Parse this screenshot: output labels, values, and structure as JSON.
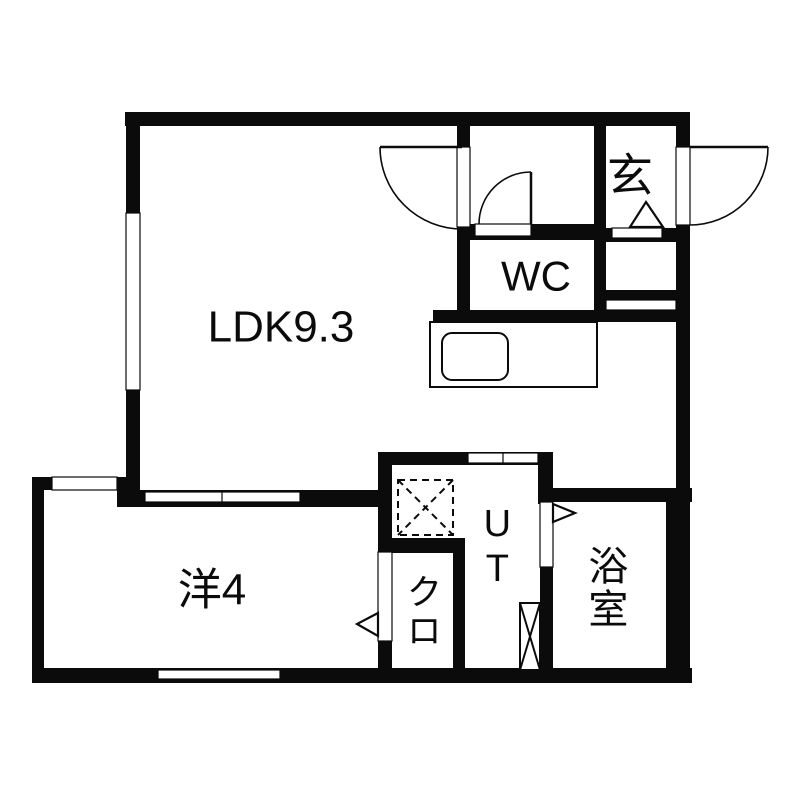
{
  "floorplan": {
    "canvas": {
      "width": 800,
      "height": 800,
      "bg": "#ffffff"
    },
    "colors": {
      "wall": "#0b0b0b",
      "line": "#0b0b0b",
      "floor": "#ffffff"
    },
    "rooms": [
      {
        "id": "ldk",
        "label": "LDK9.3",
        "x": 281,
        "y": 328,
        "font": 44,
        "orientation": "horizontal"
      },
      {
        "id": "genkan",
        "label": "玄",
        "x": 630,
        "y": 176,
        "font": 46,
        "orientation": "horizontal"
      },
      {
        "id": "wc",
        "label": "WC",
        "x": 536,
        "y": 277,
        "font": 42,
        "orientation": "horizontal"
      },
      {
        "id": "utility",
        "label": "UT",
        "x": 497,
        "y": 548,
        "font": 38,
        "orientation": "vertical"
      },
      {
        "id": "bathroom",
        "label": "浴室",
        "x": 604,
        "y": 588,
        "font": 40,
        "orientation": "vertical"
      },
      {
        "id": "closet",
        "label": "クロ",
        "x": 421,
        "y": 612,
        "font": 36,
        "orientation": "vertical"
      },
      {
        "id": "western-room",
        "label": "洋4",
        "x": 212,
        "y": 591,
        "font": 44,
        "orientation": "horizontal"
      }
    ],
    "walls": [
      {
        "name": "top-exterior",
        "x": 125,
        "y": 112,
        "w": 565,
        "h": 14
      },
      {
        "name": "left-exterior-upper",
        "x": 126,
        "y": 112,
        "w": 14,
        "h": 378
      },
      {
        "name": "left-jog",
        "x": 32,
        "y": 477,
        "w": 108,
        "h": 13
      },
      {
        "name": "left-exterior-lower",
        "x": 32,
        "y": 477,
        "w": 12,
        "h": 206
      },
      {
        "name": "bottom-exterior",
        "x": 32,
        "y": 668,
        "w": 660,
        "h": 15
      },
      {
        "name": "right-exterior",
        "x": 676,
        "y": 112,
        "w": 14,
        "h": 571
      },
      {
        "name": "genkan-wc-east-divider",
        "x": 594,
        "y": 112,
        "w": 12,
        "h": 210
      },
      {
        "name": "hall-wc-west-wall",
        "x": 457,
        "y": 126,
        "w": 13,
        "h": 196
      },
      {
        "name": "wc-north-wall",
        "x": 457,
        "y": 224,
        "w": 137,
        "h": 16
      },
      {
        "name": "genkan-south-wall",
        "x": 606,
        "y": 228,
        "w": 84,
        "h": 14
      },
      {
        "name": "corridor-south-band",
        "x": 606,
        "y": 290,
        "w": 70,
        "h": 10
      },
      {
        "name": "kitchen-back-wall",
        "x": 433,
        "y": 310,
        "w": 243,
        "h": 12
      },
      {
        "name": "ut-north-wall",
        "x": 380,
        "y": 452,
        "w": 173,
        "h": 13
      },
      {
        "name": "ut-bath-divider-stub",
        "x": 538,
        "y": 452,
        "w": 15,
        "h": 52
      },
      {
        "name": "bath-north-wall",
        "x": 538,
        "y": 488,
        "w": 154,
        "h": 14
      },
      {
        "name": "ut-bath-divider",
        "x": 540,
        "y": 502,
        "w": 13,
        "h": 168
      },
      {
        "name": "bath-east-lining",
        "x": 666,
        "y": 502,
        "w": 12,
        "h": 168
      },
      {
        "name": "closet-west-divider",
        "x": 378,
        "y": 452,
        "w": 14,
        "h": 216
      },
      {
        "name": "closet-north-wall",
        "x": 378,
        "y": 538,
        "w": 87,
        "h": 15
      },
      {
        "name": "closet-east-wall",
        "x": 453,
        "y": 540,
        "w": 12,
        "h": 128
      },
      {
        "name": "yoshitsu-north-wall",
        "x": 117,
        "y": 490,
        "w": 275,
        "h": 17
      }
    ],
    "openings": [
      {
        "name": "ldk-west-window",
        "x": 126,
        "y": 213,
        "w": 14,
        "h": 177
      },
      {
        "name": "jog-window",
        "x": 52,
        "y": 477,
        "w": 65,
        "h": 13
      },
      {
        "name": "yoshitsu-south-window",
        "x": 158,
        "y": 670,
        "w": 122,
        "h": 9
      },
      {
        "name": "entrance-door-opening",
        "x": 676,
        "y": 147,
        "w": 14,
        "h": 78
      },
      {
        "name": "ldk-hall-door-opening",
        "x": 457,
        "y": 147,
        "w": 13,
        "h": 80
      },
      {
        "name": "wc-door-opening",
        "x": 475,
        "y": 224,
        "w": 56,
        "h": 12
      },
      {
        "name": "genkan-step-notch",
        "x": 612,
        "y": 228,
        "w": 50,
        "h": 10
      },
      {
        "name": "corridor-door-slot",
        "x": 606,
        "y": 300,
        "w": 70,
        "h": 10
      },
      {
        "name": "ut-door-slot",
        "x": 468,
        "y": 453,
        "w": 70,
        "h": 10,
        "divider_x": 503
      },
      {
        "name": "ldk-yoshitsu-sliding",
        "x": 145,
        "y": 492,
        "w": 155,
        "h": 10,
        "divider_x": 222
      },
      {
        "name": "closet-door-opening",
        "x": 378,
        "y": 552,
        "w": 14,
        "h": 89
      },
      {
        "name": "bath-door-opening",
        "x": 540,
        "y": 502,
        "w": 13,
        "h": 65
      }
    ],
    "doors": [
      {
        "name": "entrance-door",
        "leaf": [
          690,
          147,
          768,
          147
        ],
        "arc": "M768,147 A78,78 0 0 1 690,225"
      },
      {
        "name": "ldk-door",
        "leaf": [
          380,
          147,
          462,
          147
        ],
        "arc": "M380,147 A82,82 0 0 0 462,229"
      },
      {
        "name": "wc-door",
        "leaf": [
          531,
          172,
          531,
          224
        ],
        "arc": "M531,172 A52,52 0 0 0 479,224"
      }
    ],
    "fixtures": {
      "kitchen_counter": {
        "x": 430,
        "y": 322,
        "w": 167,
        "h": 65
      },
      "kitchen_sink": {
        "x": 442,
        "y": 333,
        "w": 66,
        "h": 47,
        "rx": 10
      },
      "washer_space": {
        "x": 398,
        "y": 480,
        "w": 55,
        "h": 55,
        "style": "dashed-x"
      },
      "utility_box": {
        "x": 520,
        "y": 603,
        "w": 20,
        "h": 67,
        "style": "solid-x"
      },
      "triangles": [
        {
          "name": "entrance-step-mark",
          "points": "646,202 663,227 630,227"
        },
        {
          "name": "bath-door-swing-mark",
          "points": "553,504 575,513 553,522"
        },
        {
          "name": "closet-door-swing-mark",
          "points": "378,613 378,636 357,624"
        }
      ]
    }
  }
}
